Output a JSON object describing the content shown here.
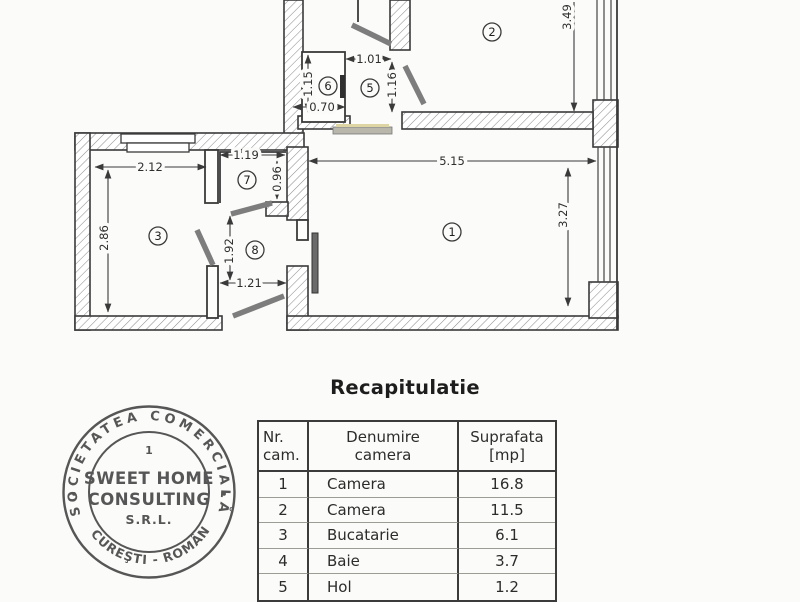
{
  "recap": {
    "title": "Recapitulatie"
  },
  "plan": {
    "rooms": {
      "r1": "1",
      "r2": "2",
      "r3": "3",
      "r5": "5",
      "r6": "6",
      "r7": "7",
      "r8": "8"
    },
    "dims": {
      "d515": "5.15",
      "d327": "3.27",
      "d349": "3.49",
      "d212": "2.12",
      "d286": "2.86",
      "d119": "1.19",
      "d096": "0.96",
      "d192": "1.92",
      "d121": "1.21",
      "d115": "1.15",
      "d070": "0.70",
      "d101": "1.01",
      "d116": "1.16"
    }
  },
  "table": {
    "headers": {
      "nr_l1": "Nr.",
      "nr_l2": "cam.",
      "name_l1": "Denumire",
      "name_l2": "camera",
      "area_l1": "Suprafata",
      "area_l2": "[mp]"
    },
    "rows": [
      {
        "nr": "1",
        "name": "Camera",
        "area": "16.8"
      },
      {
        "nr": "2",
        "name": "Camera",
        "area": "11.5"
      },
      {
        "nr": "3",
        "name": "Bucatarie",
        "area": "6.1"
      },
      {
        "nr": "4",
        "name": "Baie",
        "area": "3.7"
      },
      {
        "nr": "5",
        "name": "Hol",
        "area": "1.2"
      }
    ]
  },
  "stamp": {
    "arc_top": "SOCIETATEA COMERCIALĂ",
    "arc_bottom": "BUCUREŞTI - ROMÂNIA",
    "line1": "1",
    "line2": "SWEET HOME",
    "line3": "CONSULTING",
    "line4": "S.R.L.",
    "dot_left": "•",
    "dot_right": "•"
  },
  "colors": {
    "ink": "#3a3a3a",
    "paper": "#fbfbf9",
    "stamp_ink": "#4a4a4a"
  }
}
